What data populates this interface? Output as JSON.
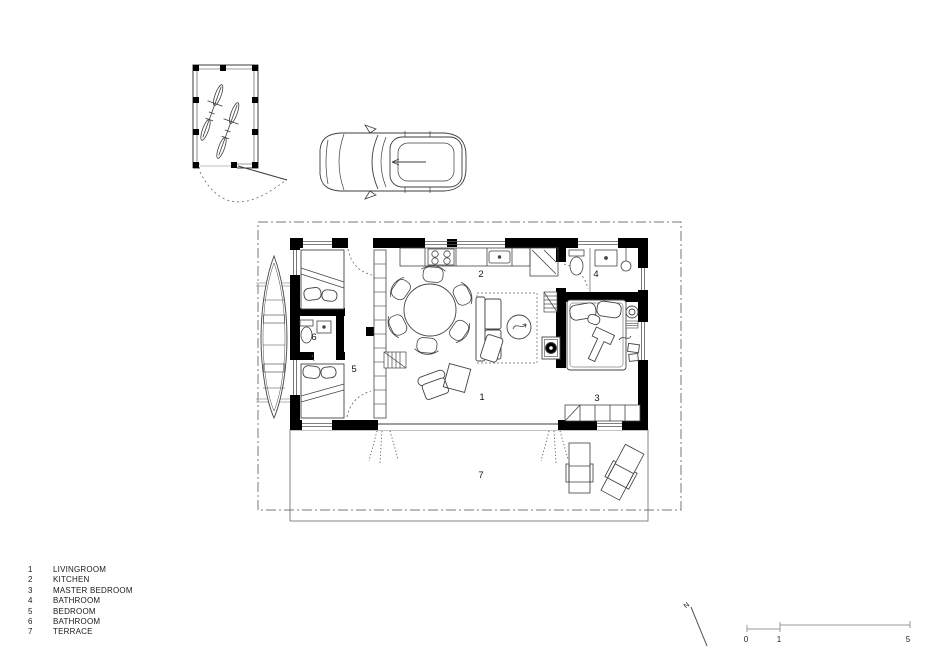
{
  "title": "Small house floor plan",
  "legend": {
    "items": [
      {
        "number": "1",
        "label": "LIVINGROOM"
      },
      {
        "number": "2",
        "label": "KITCHEN"
      },
      {
        "number": "3",
        "label": "MASTER BEDROOM"
      },
      {
        "number": "4",
        "label": "BATHROOM"
      },
      {
        "number": "5",
        "label": "BEDROOM"
      },
      {
        "number": "6",
        "label": "BATHROOM"
      },
      {
        "number": "7",
        "label": "TERRACE"
      }
    ]
  },
  "plan": {
    "rooms": {
      "livingroom": "1",
      "kitchen": "2",
      "master_bedroom": "3",
      "bathroom": "4",
      "bedroom": "5",
      "bathroom2": "6",
      "terrace": "7"
    }
  },
  "scale_bar": {
    "tick_0": "0",
    "tick_1": "1",
    "tick_5": "5"
  },
  "north_arrow": {
    "label": "N"
  },
  "colors": {
    "wall": "#000000",
    "line": "#3d3d3d",
    "thin": "#8a8a8a",
    "text": "#1a1a1a"
  }
}
